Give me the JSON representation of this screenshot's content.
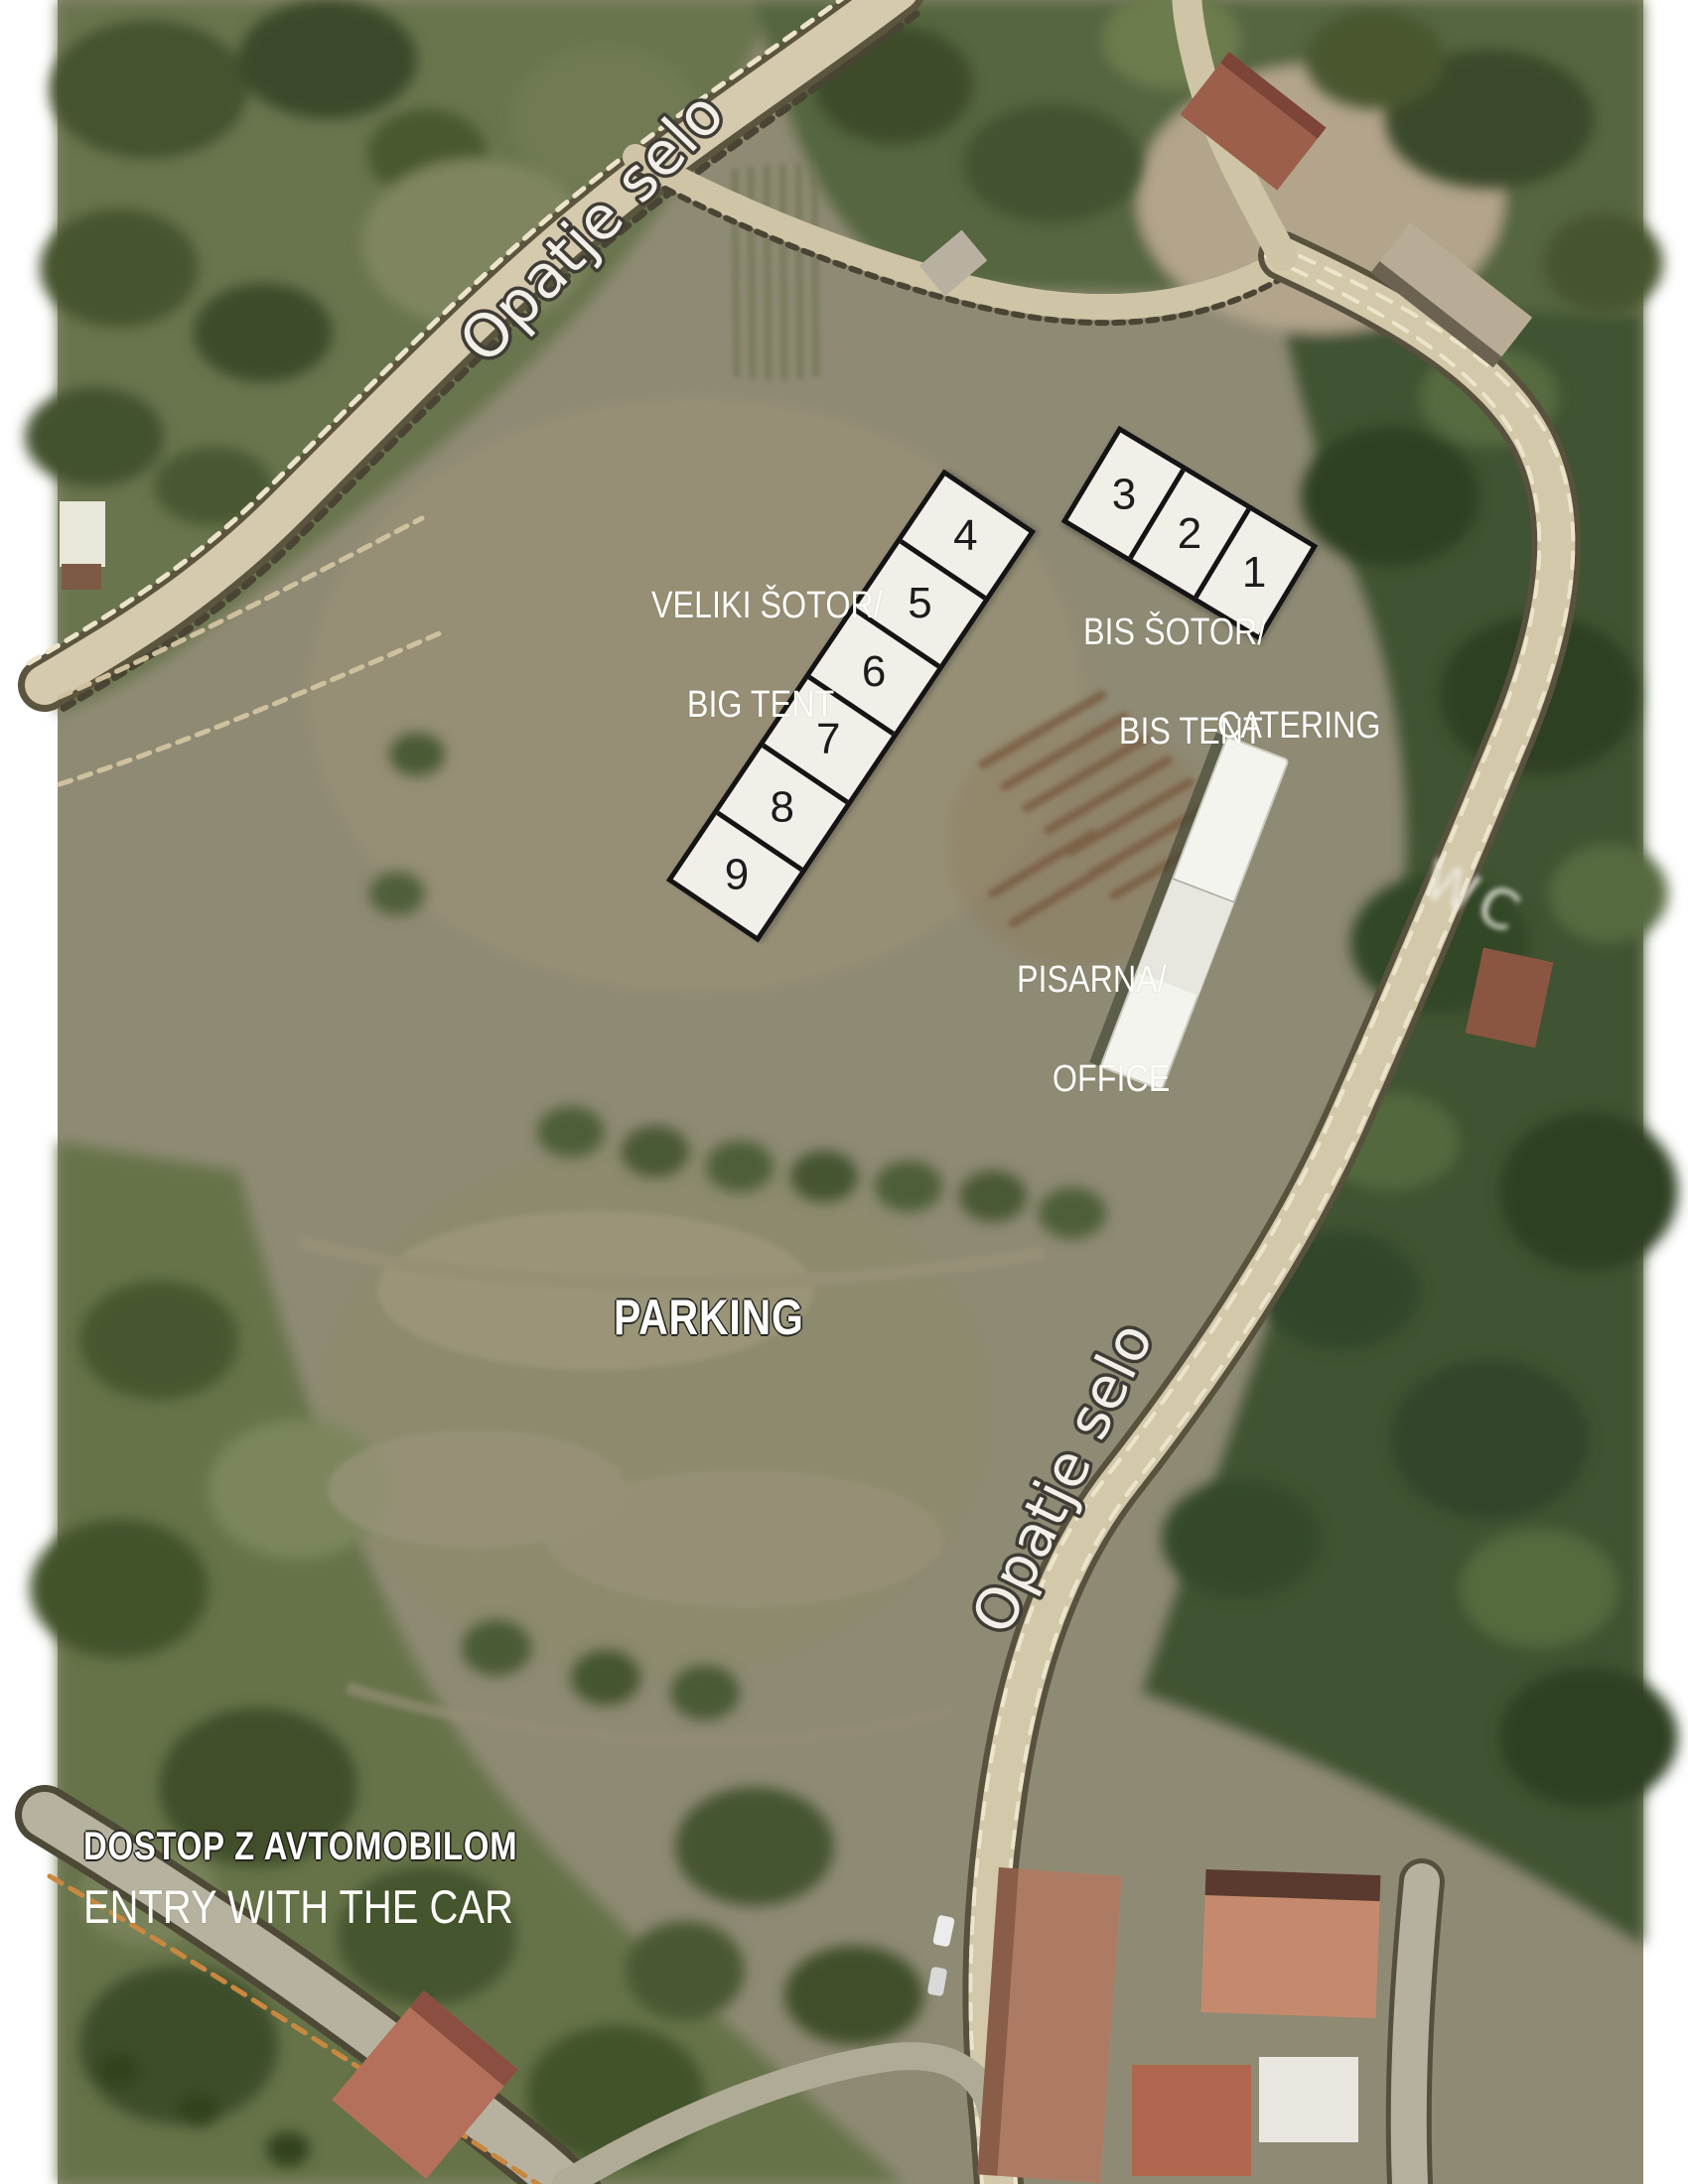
{
  "map_labels": {
    "veliki_line1": "VELIKI ŠOTOR/",
    "veliki_line2": "BIG TENT",
    "bis_line1": "BIS ŠOTOR/",
    "bis_line2": "BIS TENT",
    "catering": "CATERING",
    "pisarna_line1": "PISARNA/",
    "pisarna_line2": "OFFICE",
    "parking": "PARKING",
    "dostop": "DOSTOP Z AVTOMOBILOM",
    "entry": "ENTRY WITH THE CAR",
    "wc": "WC"
  },
  "roads": {
    "label_top": "Opatje selo",
    "label_right": "Opatje selo"
  },
  "tents": {
    "big": {
      "name": "VELIKI ŠOTOR / BIG TENT",
      "cells": [
        "9",
        "8",
        "7",
        "6",
        "5",
        "4"
      ]
    },
    "bis": {
      "name": "BIS ŠOTOR / BIS TENT",
      "cells": [
        "3",
        "2",
        "1"
      ]
    }
  },
  "colors": {
    "tent_fill": "#f2eee8",
    "tent_border": "#141414",
    "label_white": "#fdfdfa",
    "road_tan": "#d5caad",
    "field_olive": "#8f8a74",
    "trees_dark": "#3f5233",
    "roof_red": "#b4705a",
    "building_white": "#f4f4ee",
    "page_margin": "#ffffff"
  }
}
